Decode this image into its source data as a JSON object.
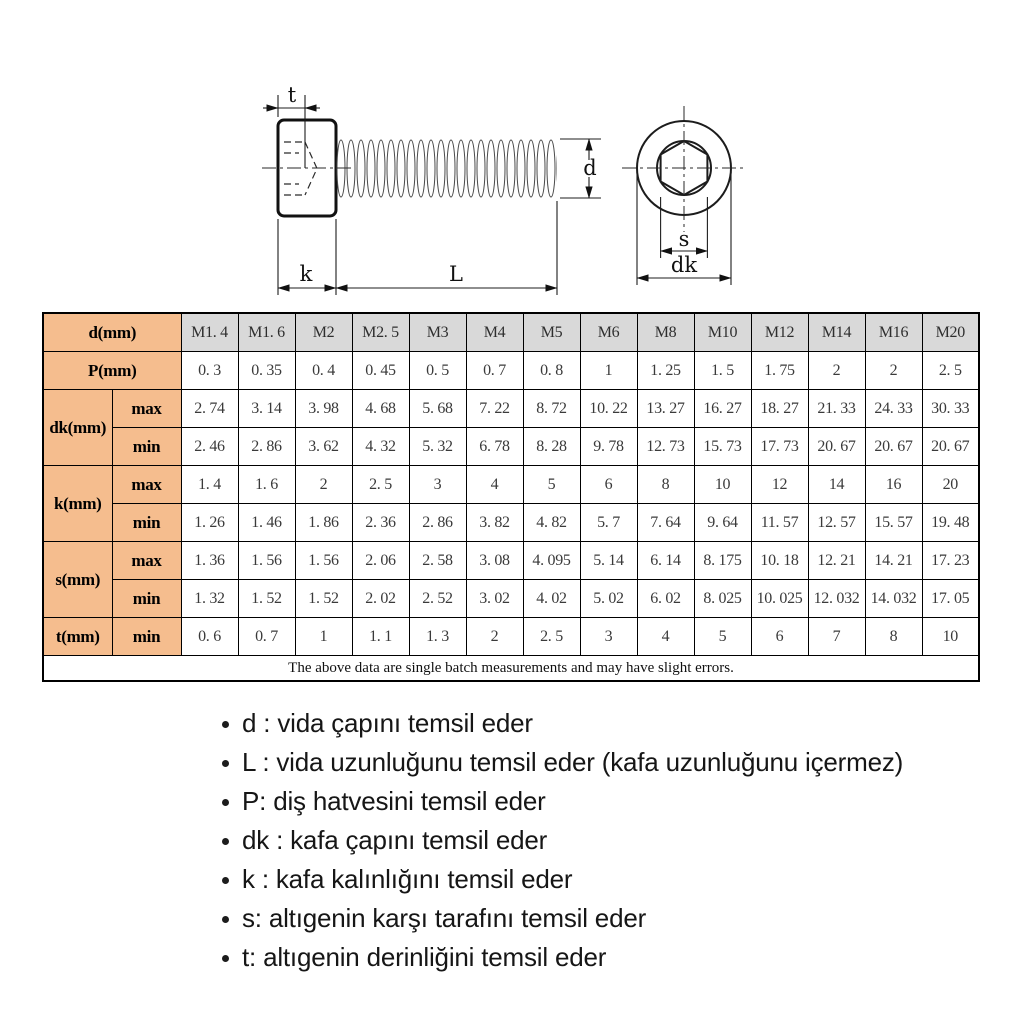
{
  "colors": {
    "peach": "#F5BD8E",
    "gray": "#D9D9D9",
    "border": "#000000"
  },
  "diagram": {
    "labels": {
      "t": "t",
      "k": "k",
      "l": "L",
      "d": "d",
      "s": "s",
      "dk": "dk"
    }
  },
  "table": {
    "d_row": {
      "label": "d(mm)",
      "sizes": [
        "M1. 4",
        "M1. 6",
        "M2",
        "M2. 5",
        "M3",
        "M4",
        "M5",
        "M6",
        "M8",
        "M10",
        "M12",
        "M14",
        "M16",
        "M20"
      ]
    },
    "p_row": {
      "label": "P(mm)",
      "values": [
        "0. 3",
        "0. 35",
        "0. 4",
        "0. 45",
        "0. 5",
        "0. 7",
        "0. 8",
        "1",
        "1. 25",
        "1. 5",
        "1. 75",
        "2",
        "2",
        "2. 5"
      ]
    },
    "groups": [
      {
        "label": "dk(mm)",
        "subrows": [
          {
            "name": "max",
            "values": [
              "2. 74",
              "3. 14",
              "3. 98",
              "4. 68",
              "5. 68",
              "7. 22",
              "8. 72",
              "10. 22",
              "13. 27",
              "16. 27",
              "18. 27",
              "21. 33",
              "24. 33",
              "30. 33"
            ]
          },
          {
            "name": "min",
            "values": [
              "2. 46",
              "2. 86",
              "3. 62",
              "4. 32",
              "5. 32",
              "6. 78",
              "8. 28",
              "9. 78",
              "12. 73",
              "15. 73",
              "17. 73",
              "20. 67",
              "20. 67",
              "20. 67"
            ]
          }
        ]
      },
      {
        "label": "k(mm)",
        "subrows": [
          {
            "name": "max",
            "values": [
              "1. 4",
              "1. 6",
              "2",
              "2. 5",
              "3",
              "4",
              "5",
              "6",
              "8",
              "10",
              "12",
              "14",
              "16",
              "20"
            ]
          },
          {
            "name": "min",
            "values": [
              "1. 26",
              "1. 46",
              "1. 86",
              "2. 36",
              "2. 86",
              "3. 82",
              "4. 82",
              "5. 7",
              "7. 64",
              "9. 64",
              "11. 57",
              "12. 57",
              "15. 57",
              "19. 48"
            ]
          }
        ]
      },
      {
        "label": "s(mm)",
        "subrows": [
          {
            "name": "max",
            "values": [
              "1. 36",
              "1. 56",
              "1. 56",
              "2. 06",
              "2. 58",
              "3. 08",
              "4. 095",
              "5. 14",
              "6. 14",
              "8. 175",
              "10. 18",
              "12. 21",
              "14. 21",
              "17. 23"
            ]
          },
          {
            "name": "min",
            "values": [
              "1. 32",
              "1. 52",
              "1. 52",
              "2. 02",
              "2. 52",
              "3. 02",
              "4. 02",
              "5. 02",
              "6. 02",
              "8. 025",
              "10. 025",
              "12. 032",
              "14. 032",
              "17. 05"
            ]
          }
        ]
      },
      {
        "label": "t(mm)",
        "subrows": [
          {
            "name": "min",
            "values": [
              "0. 6",
              "0. 7",
              "1",
              "1. 1",
              "1. 3",
              "2",
              "2. 5",
              "3",
              "4",
              "5",
              "6",
              "7",
              "8",
              "10"
            ]
          }
        ]
      }
    ],
    "footer": "The above data are single batch measurements and may have slight errors."
  },
  "legend": {
    "items": [
      "d : vida çapını temsil eder",
      "L : vida uzunluğunu temsil eder (kafa uzunluğunu içermez)",
      "P: diş hatvesini temsil eder",
      "dk : kafa çapını temsil eder",
      "k : kafa kalınlığını temsil eder",
      "s: altıgenin karşı tarafını temsil eder",
      "t: altıgenin derinliğini temsil eder"
    ]
  }
}
